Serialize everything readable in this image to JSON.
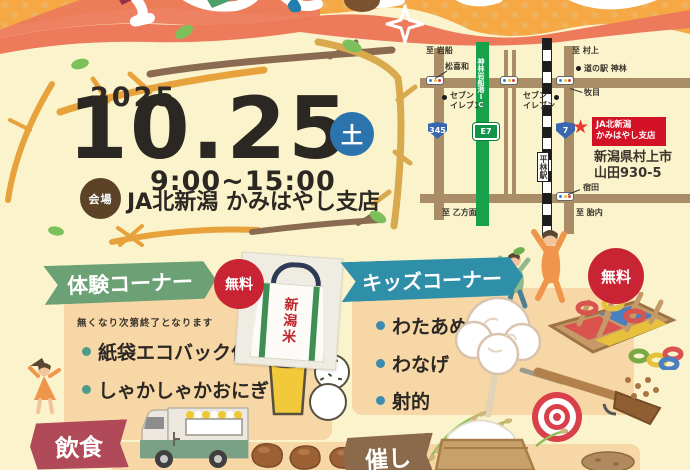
{
  "event": {
    "year": "2025",
    "date": "10.25",
    "weekday": "土",
    "time": "9:00~15:00",
    "venue_label": "会場",
    "venue_name": "JA北新潟 かみはやし支店"
  },
  "map": {
    "to_iwafune": "至 岩船",
    "to_murakami": "至 村上",
    "to_otsu": "至 乙方面",
    "to_tainai": "至 胎内",
    "matsukiwa": "松喜和",
    "michinoeki": "道の駅 神林",
    "makime": "牧目",
    "shukuda": "宿田",
    "seven_left": "セブン\nイレブン",
    "seven_center": "セブン\nイレブン",
    "ic_name": "神林岩船港IC",
    "station": "平林駅",
    "route_345": "345",
    "route_7": "7",
    "route_e7": "E7",
    "dest_name_1": "JA北新潟",
    "dest_name_2": "かみはやし支店",
    "address_1": "新潟県村上市",
    "address_2": "山田930-5",
    "star": "★"
  },
  "sections": {
    "taiken": {
      "title": "体験コーナー",
      "badge": "無料",
      "note": "無くなり次第終了となります",
      "items": [
        "紙袋エコバック作り",
        "しゃかしゃかおにぎり"
      ]
    },
    "kids": {
      "title": "キッズコーナー",
      "badge": "無料",
      "items": [
        "わたあめ",
        "わなげ",
        "射的"
      ]
    },
    "food": {
      "title": "飲食"
    },
    "events": {
      "title": "催し"
    }
  },
  "photo": {
    "bag_text": "新潟米"
  },
  "colors": {
    "cream": "#faf3cb",
    "card_peach": "#f8d7a6",
    "coral": "#ec7a5b",
    "orange": "#f5a843",
    "banner_green": "#6ba175",
    "banner_teal": "#2f8fa9",
    "banner_maroon": "#b04a58",
    "banner_brown": "#8a6a4a",
    "free_red": "#c92433",
    "day_blue": "#2c74ad",
    "venue_brown": "#5c4327",
    "highway_green": "#17a14b",
    "road_brown": "#a88d66",
    "dest_red": "#d41225"
  }
}
